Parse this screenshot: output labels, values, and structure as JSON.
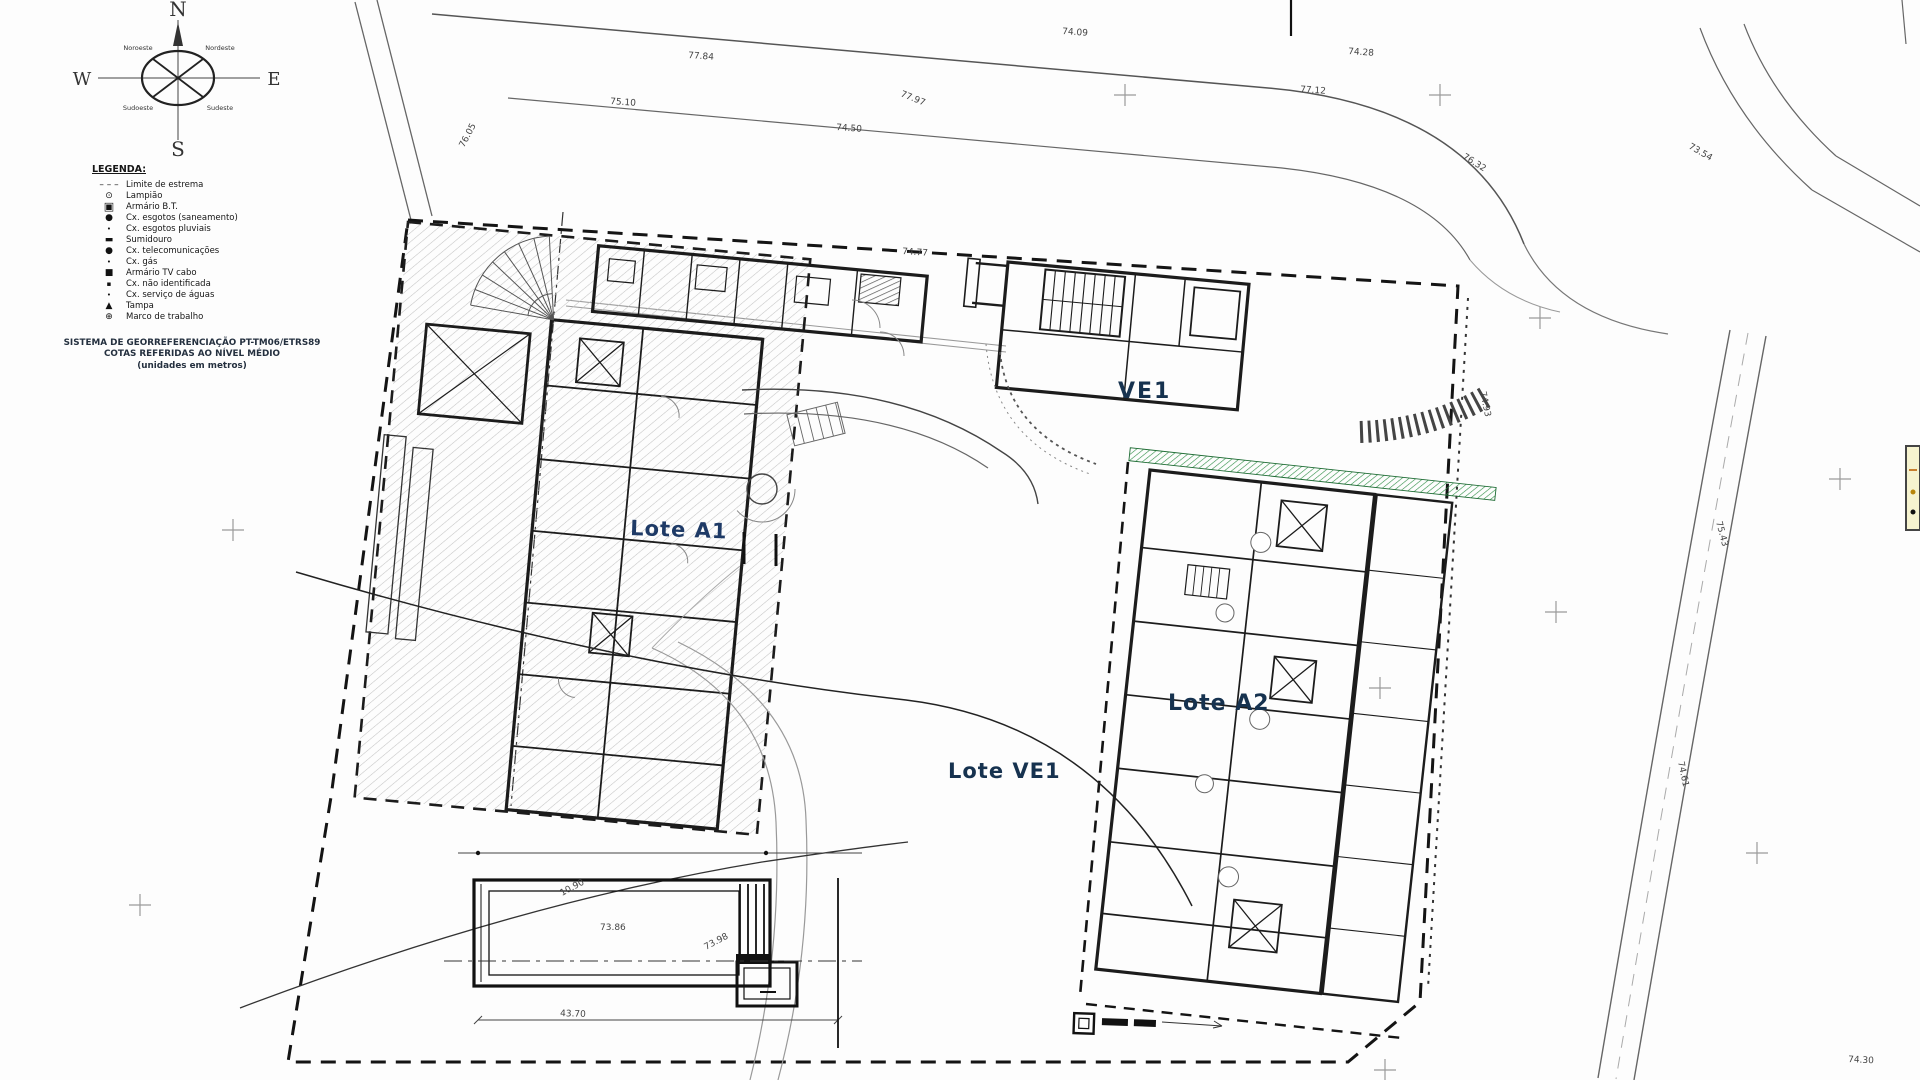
{
  "drawing": {
    "compass": {
      "n": "N",
      "s": "S",
      "e": "E",
      "w": "W",
      "nw": "Noroeste",
      "ne": "Nordeste",
      "sw": "Sudoeste",
      "se": "Sudeste"
    },
    "legend": {
      "title": "LEGENDA:",
      "items": [
        {
          "icon": "boundary-line-sample",
          "glyph": "– – –",
          "label": "Limite de estrema"
        },
        {
          "icon": "lamp-post-symbol",
          "glyph": "⊙",
          "label": "Lampião"
        },
        {
          "icon": "bt-cabinet-symbol",
          "glyph": "▣",
          "label": "Armário B.T."
        },
        {
          "icon": "sewer-box-symbol",
          "glyph": "●",
          "label": "Cx. esgotos (saneamento)"
        },
        {
          "icon": "storm-drain-box-symbol",
          "glyph": "•",
          "label": "Cx. esgotos pluviais"
        },
        {
          "icon": "gully-symbol",
          "glyph": "▬",
          "label": "Sumidouro"
        },
        {
          "icon": "telecom-box-symbol",
          "glyph": "●",
          "label": "Cx. telecomunicações"
        },
        {
          "icon": "gas-box-symbol",
          "glyph": "•",
          "label": "Cx. gás"
        },
        {
          "icon": "tv-cabinet-symbol",
          "glyph": "■",
          "label": "Armário TV cabo"
        },
        {
          "icon": "unknown-box-symbol",
          "glyph": "▪",
          "label": "Cx. não identificada"
        },
        {
          "icon": "water-box-symbol",
          "glyph": "•",
          "label": "Cx. serviço de águas"
        },
        {
          "icon": "cover-symbol",
          "glyph": "▲",
          "label": "Tampa"
        },
        {
          "icon": "survey-mark-symbol",
          "glyph": "⊕",
          "label": "Marco de trabalho"
        }
      ]
    },
    "georef": [
      "SISTEMA DE GEORREFERENCIAÇÃO PT-TM06/ETRS89",
      "COTAS REFERIDAS AO NÍVEL MÉDIO",
      "(unidades em metros)"
    ],
    "lots": {
      "a1": "Lote A1",
      "a2": "Lote A2",
      "ve1": "VE1",
      "lote_ve1": "Lote VE1"
    },
    "annotations": [
      "77.84",
      "77.97",
      "74.09",
      "77.12",
      "76.32",
      "74.50",
      "75.10",
      "73.86",
      "10.90",
      "73.98",
      "43.70",
      "74.93",
      "74.28",
      "73.54",
      "75.43",
      "74.61",
      "76.05",
      "74.77",
      "74.30"
    ],
    "colors": {
      "line": "#1a1a1a",
      "road": "#666666",
      "lot_label": "#1e3a66",
      "green_strip": "#1d6b33",
      "hatch": "#c3c3c3",
      "yellow_box": "#f6f3cf"
    }
  }
}
